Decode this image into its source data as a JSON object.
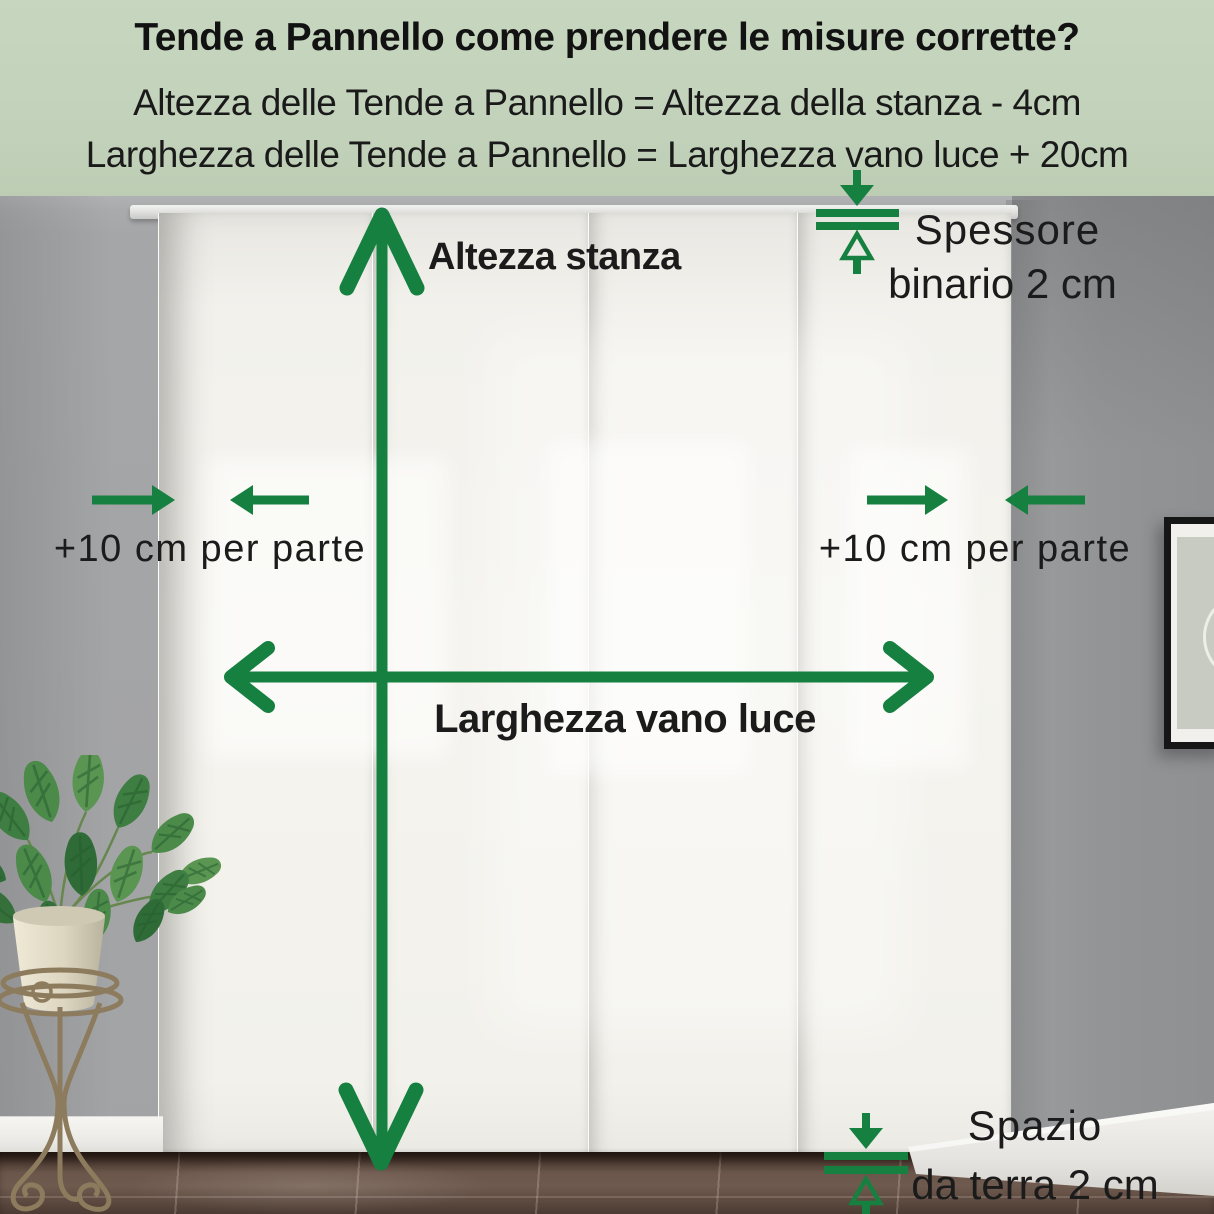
{
  "header": {
    "title": "Tende a Pannello come prendere le misure corrette?",
    "formula_height": "Altezza delle Tende a Pannello = Altezza della stanza - 4cm",
    "formula_width": "Larghezza delle Tende a Pannello = Larghezza vano luce + 20cm"
  },
  "annotations": {
    "room_height": "Altezza stanza",
    "opening_width": "Larghezza vano luce",
    "track_thickness_line1": "Spessore",
    "track_thickness_line2": "binario 2 cm",
    "side_allowance_left": "+10 cm per parte",
    "side_allowance_right": "+10 cm per parte",
    "floor_gap_line1": "Spazio",
    "floor_gap_line2": "da terra 2 cm"
  },
  "colors": {
    "accent_green": "#15803f",
    "header_bg": "#c4d4bc",
    "wall_gray": "#a2a3a5",
    "curtain_white": "#f4f3ee",
    "floor_brown": "#5c493f",
    "text_black": "#1b1b1b"
  }
}
